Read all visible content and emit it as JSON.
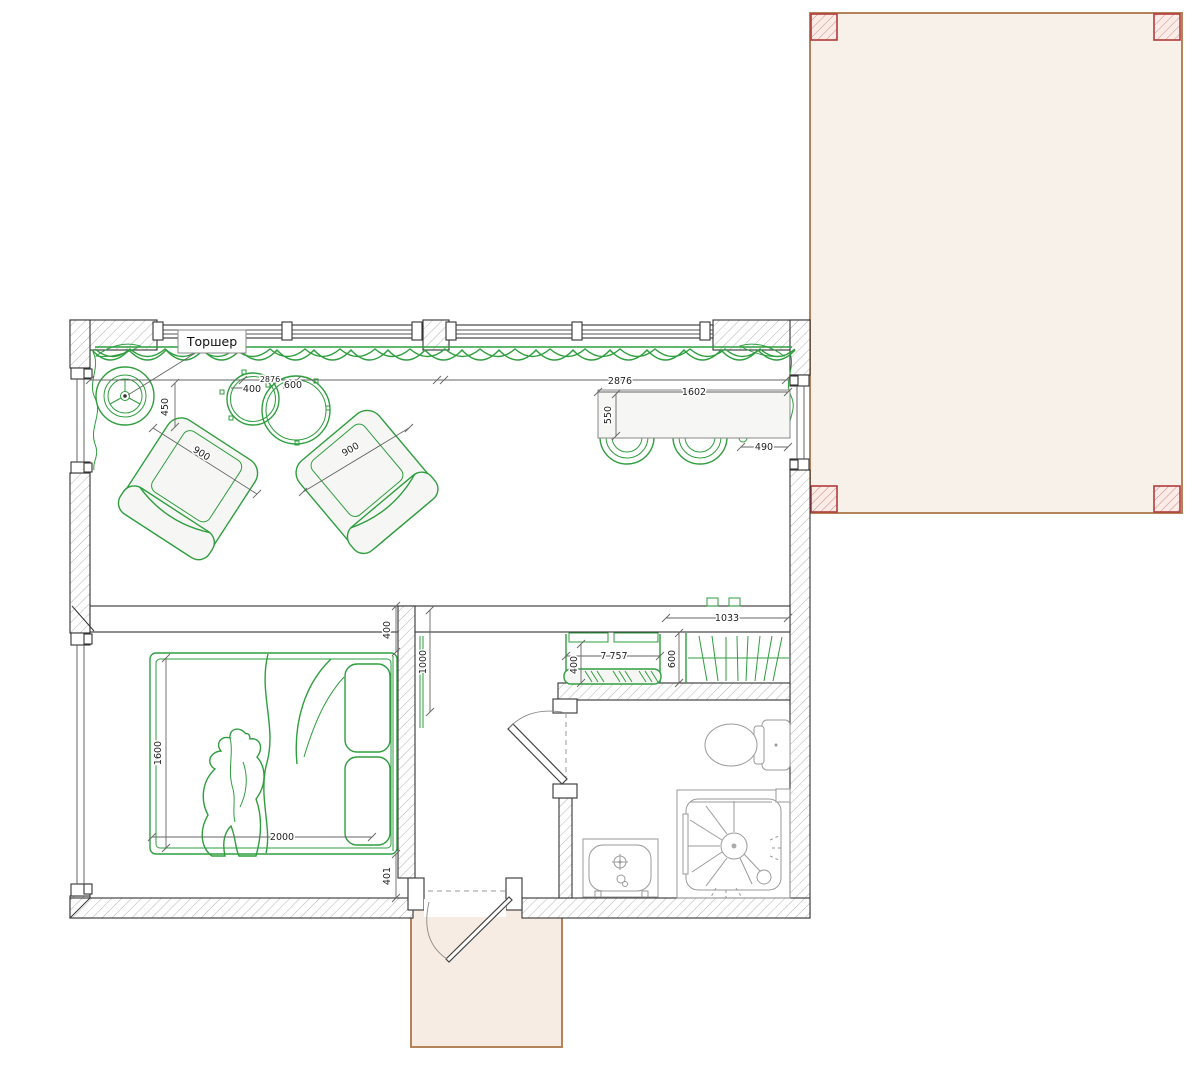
{
  "labels": {
    "floor_lamp": "Торшер"
  },
  "dimensions": {
    "living_room": {
      "lamp_to_chair": "450",
      "small_table": "400",
      "window_bay_small_text": "2876",
      "large_table": "600",
      "armchair_left": "900",
      "armchair_right": "900",
      "window_bay": "2876",
      "dining_table_length": "1602",
      "dining_table_depth": "550",
      "table_to_wall": "490"
    },
    "bedroom": {
      "bed_head_gap": "400",
      "bed_width": "1600",
      "bed_length": "2000",
      "bed_foot_gap": "401"
    },
    "hallway": {
      "passage_width": "1000",
      "wardrobe_width": "1033",
      "wardrobe_depth": "600",
      "bench_width": "7 757",
      "bench_depth": "400"
    }
  },
  "colors": {
    "furniture_green": "#2f9e3f",
    "furniture_fill": "#f6f7f4",
    "wall_line": "#333333",
    "dim_line": "#666666",
    "dimension_text": "#222222",
    "terrace_fill": "#f8f1e9",
    "terrace_border": "#b5835a",
    "post_red": "#b23b3b",
    "porch_fill": "#f7ece3",
    "fixture_gray": "#9a9a9a"
  }
}
